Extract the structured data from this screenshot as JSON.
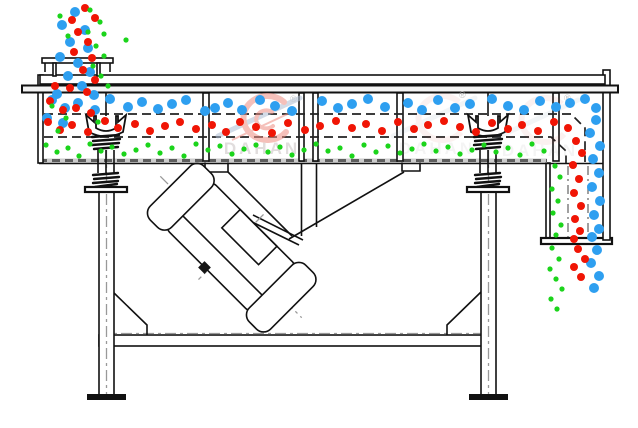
{
  "watermark": {
    "brand": "DAHAN",
    "registered_mark": "®"
  },
  "colors": {
    "blue": "#2e9ff0",
    "red": "#f01505",
    "green": "#1bd41b",
    "watermark_pink": "#ee8d83",
    "watermark_swoosh": "#aebfd4",
    "watermark_text": "#c9c2c2",
    "structure": "#111111"
  },
  "particles": {
    "coarse-blue": {
      "color": "#2e9ff0",
      "radius": 5,
      "points": [
        [
          52,
          100
        ],
        [
          65,
          108
        ],
        [
          78,
          103
        ],
        [
          95,
          110
        ],
        [
          110,
          99
        ],
        [
          128,
          107
        ],
        [
          142,
          102
        ],
        [
          158,
          109
        ],
        [
          172,
          104
        ],
        [
          186,
          100
        ],
        [
          205,
          111
        ],
        [
          215,
          108
        ],
        [
          228,
          103
        ],
        [
          242,
          110
        ],
        [
          260,
          100
        ],
        [
          275,
          106
        ],
        [
          292,
          111
        ],
        [
          322,
          101
        ],
        [
          338,
          108
        ],
        [
          352,
          104
        ],
        [
          368,
          99
        ],
        [
          385,
          107
        ],
        [
          408,
          103
        ],
        [
          422,
          110
        ],
        [
          438,
          100
        ],
        [
          455,
          108
        ],
        [
          470,
          104
        ],
        [
          492,
          99
        ],
        [
          508,
          106
        ],
        [
          524,
          110
        ],
        [
          540,
          101
        ],
        [
          556,
          107
        ],
        [
          570,
          103
        ],
        [
          585,
          99
        ],
        [
          596,
          108
        ],
        [
          47,
          118
        ],
        [
          63,
          123
        ],
        [
          596,
          120
        ],
        [
          590,
          133
        ],
        [
          600,
          146
        ],
        [
          593,
          159
        ],
        [
          599,
          173
        ],
        [
          592,
          187
        ],
        [
          600,
          201
        ],
        [
          594,
          215
        ],
        [
          599,
          229
        ],
        [
          592,
          237
        ],
        [
          597,
          250
        ],
        [
          591,
          263
        ],
        [
          599,
          276
        ],
        [
          594,
          288
        ],
        [
          75,
          12
        ],
        [
          62,
          25
        ],
        [
          85,
          30
        ],
        [
          70,
          42
        ],
        [
          88,
          48
        ],
        [
          60,
          57
        ],
        [
          78,
          63
        ],
        [
          90,
          72
        ],
        [
          68,
          76
        ],
        [
          82,
          86
        ],
        [
          57,
          94
        ],
        [
          94,
          95
        ]
      ]
    },
    "medium-red": {
      "color": "#f01505",
      "radius": 4,
      "points": [
        [
          48,
          122
        ],
        [
          60,
          130
        ],
        [
          72,
          125
        ],
        [
          88,
          132
        ],
        [
          105,
          121
        ],
        [
          118,
          128
        ],
        [
          135,
          124
        ],
        [
          150,
          131
        ],
        [
          165,
          126
        ],
        [
          180,
          122
        ],
        [
          196,
          129
        ],
        [
          212,
          125
        ],
        [
          226,
          132
        ],
        [
          240,
          122
        ],
        [
          256,
          127
        ],
        [
          272,
          133
        ],
        [
          288,
          123
        ],
        [
          305,
          130
        ],
        [
          320,
          126
        ],
        [
          336,
          121
        ],
        [
          352,
          128
        ],
        [
          366,
          124
        ],
        [
          382,
          131
        ],
        [
          398,
          122
        ],
        [
          414,
          129
        ],
        [
          428,
          125
        ],
        [
          444,
          121
        ],
        [
          460,
          127
        ],
        [
          476,
          132
        ],
        [
          492,
          123
        ],
        [
          508,
          129
        ],
        [
          522,
          125
        ],
        [
          538,
          131
        ],
        [
          554,
          122
        ],
        [
          568,
          128
        ],
        [
          576,
          141
        ],
        [
          582,
          153
        ],
        [
          573,
          165
        ],
        [
          579,
          179
        ],
        [
          574,
          193
        ],
        [
          581,
          206
        ],
        [
          575,
          219
        ],
        [
          580,
          231
        ],
        [
          574,
          239
        ],
        [
          578,
          249
        ],
        [
          585,
          259
        ],
        [
          574,
          267
        ],
        [
          581,
          277
        ],
        [
          85,
          8
        ],
        [
          72,
          20
        ],
        [
          95,
          18
        ],
        [
          78,
          32
        ],
        [
          88,
          42
        ],
        [
          74,
          52
        ],
        [
          92,
          58
        ],
        [
          83,
          70
        ],
        [
          95,
          80
        ],
        [
          70,
          88
        ],
        [
          87,
          92
        ],
        [
          55,
          86
        ],
        [
          50,
          101
        ],
        [
          63,
          110
        ],
        [
          76,
          108
        ],
        [
          91,
          113
        ]
      ]
    },
    "fine-green": {
      "color": "#1bd41b",
      "radius": 2.6,
      "points": [
        [
          46,
          145
        ],
        [
          57,
          152
        ],
        [
          68,
          148
        ],
        [
          79,
          156
        ],
        [
          90,
          144
        ],
        [
          101,
          151
        ],
        [
          112,
          147
        ],
        [
          124,
          154
        ],
        [
          136,
          150
        ],
        [
          148,
          145
        ],
        [
          160,
          153
        ],
        [
          172,
          148
        ],
        [
          184,
          156
        ],
        [
          196,
          144
        ],
        [
          208,
          150
        ],
        [
          220,
          146
        ],
        [
          232,
          154
        ],
        [
          244,
          149
        ],
        [
          256,
          145
        ],
        [
          268,
          152
        ],
        [
          280,
          147
        ],
        [
          292,
          155
        ],
        [
          304,
          150
        ],
        [
          316,
          144
        ],
        [
          328,
          151
        ],
        [
          340,
          148
        ],
        [
          352,
          156
        ],
        [
          364,
          145
        ],
        [
          376,
          152
        ],
        [
          388,
          146
        ],
        [
          400,
          153
        ],
        [
          412,
          149
        ],
        [
          424,
          144
        ],
        [
          436,
          151
        ],
        [
          448,
          147
        ],
        [
          460,
          154
        ],
        [
          472,
          150
        ],
        [
          484,
          145
        ],
        [
          496,
          152
        ],
        [
          508,
          148
        ],
        [
          520,
          155
        ],
        [
          532,
          144
        ],
        [
          544,
          151
        ],
        [
          555,
          166
        ],
        [
          560,
          177
        ],
        [
          552,
          189
        ],
        [
          558,
          201
        ],
        [
          553,
          213
        ],
        [
          561,
          225
        ],
        [
          556,
          235
        ],
        [
          552,
          248
        ],
        [
          559,
          259
        ],
        [
          550,
          269
        ],
        [
          556,
          279
        ],
        [
          562,
          289
        ],
        [
          551,
          299
        ],
        [
          557,
          309
        ],
        [
          90,
          10
        ],
        [
          100,
          22
        ],
        [
          88,
          32
        ],
        [
          104,
          34
        ],
        [
          96,
          46
        ],
        [
          104,
          56
        ],
        [
          93,
          66
        ],
        [
          101,
          76
        ],
        [
          108,
          86
        ],
        [
          126,
          40
        ],
        [
          60,
          16
        ],
        [
          68,
          36
        ],
        [
          52,
          106
        ],
        [
          66,
          118
        ],
        [
          98,
          122
        ],
        [
          58,
          131
        ]
      ]
    }
  }
}
